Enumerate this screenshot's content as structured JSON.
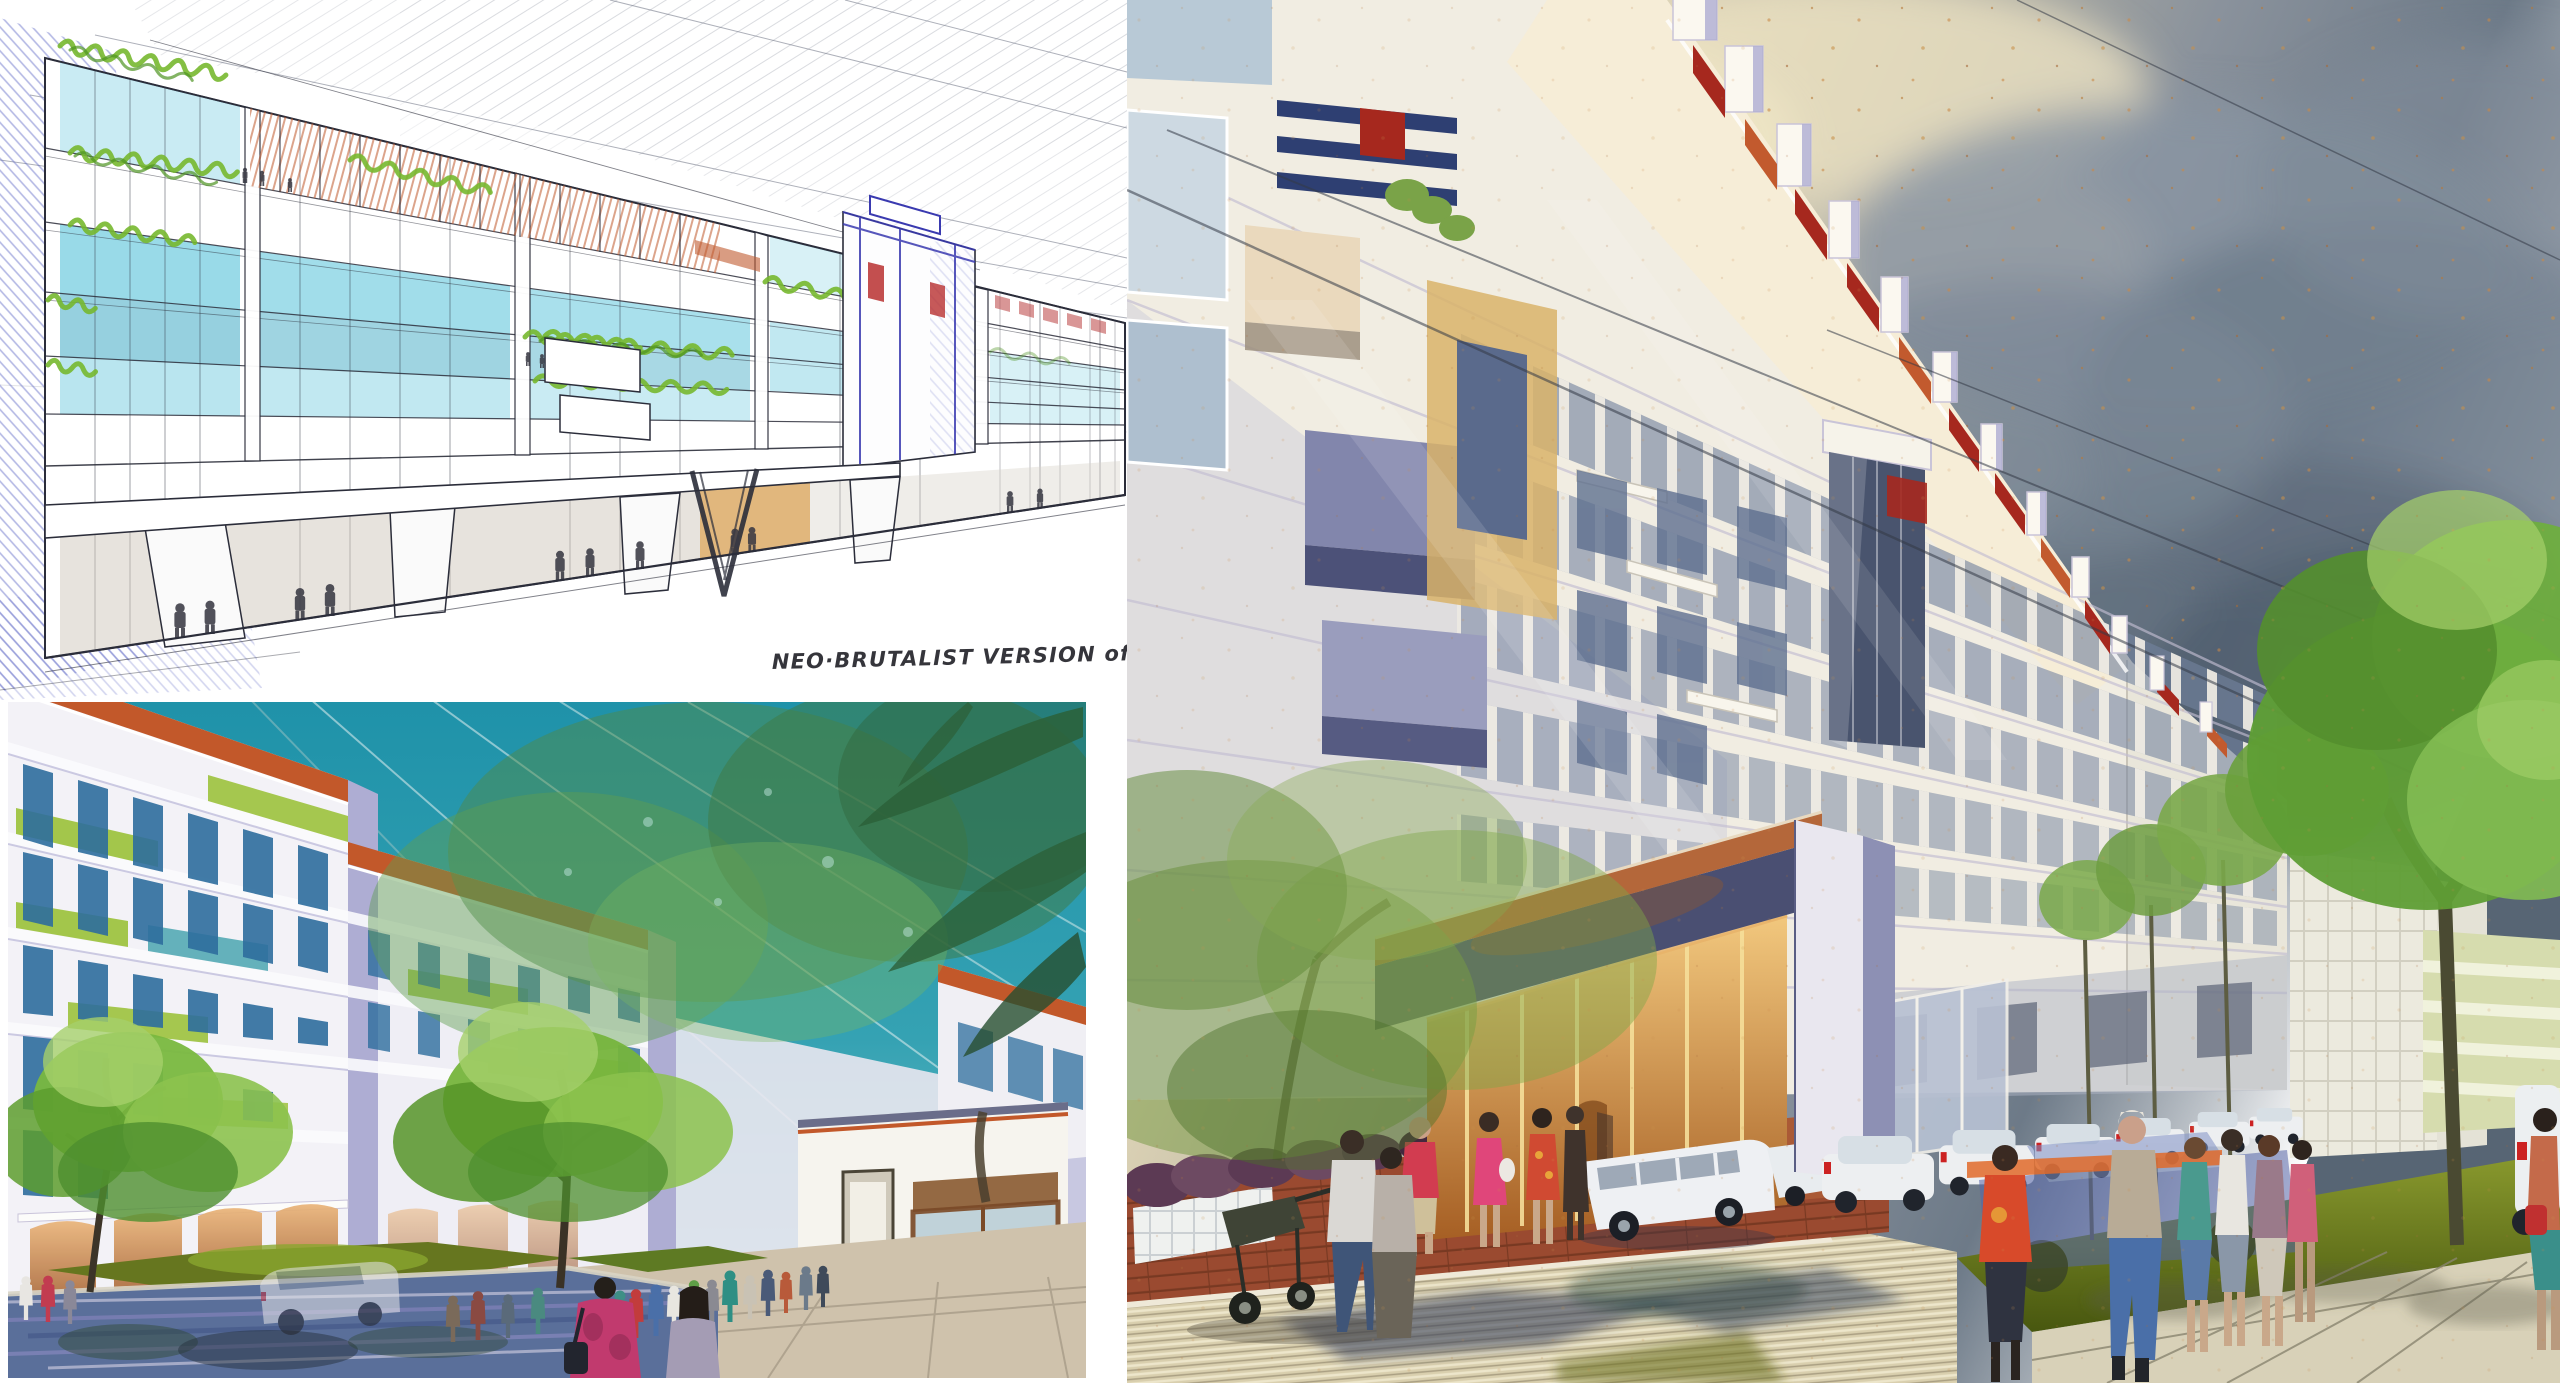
{
  "annotation": {
    "text": "NEO·BRUTALIST VERSION of ART·DECO"
  },
  "palette": {
    "paper": "#ffffff",
    "ink": "#2b2d3a",
    "sketch_blue": "#4d58c0",
    "sketch_cyan": "#63c6dc",
    "sketch_teal": "#3fa9c4",
    "sketch_green": "#77b82e",
    "sketch_red": "#c05a2e",
    "amber_glow": "#daa55c",
    "teal_sky": "#2697ad",
    "leaf_green": "#79b83f",
    "leaf_light": "#a5d06a",
    "palm_green": "#2c6038",
    "orange_fascia": "#c2582a",
    "lime_balcony": "#9cc23c",
    "window_blue": "#2e6e9e",
    "lavender_shade": "#aeadd3",
    "cream_sky": "#ede4c6",
    "storm_sky": "#5f6d7c",
    "deco_white": "#f1ede2",
    "deco_shadow": "#b7b9d4",
    "deco_red": "#a6281e",
    "deco_tan": "#d9b36a",
    "deco_blue_stripe": "#2e3f72",
    "canopy_soffit": "#4a4f72",
    "canopy_fascia": "#b4673a",
    "street_tan": "#d9cfae",
    "paving_red": "#9a4a30",
    "grass_olive": "#66761f",
    "ghost_car_blue": "#5565a8",
    "taillight_red": "#cc2222"
  }
}
